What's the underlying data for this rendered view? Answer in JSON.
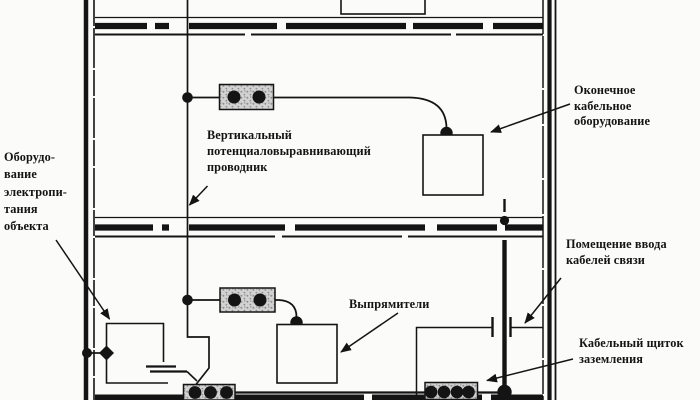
{
  "colors": {
    "ink": "#141414",
    "paper": "#fbfbf9",
    "busbar_fill": "#d2d2d2",
    "busbar_speckle": "#8f8f8f"
  },
  "labels": {
    "power_equipment": "Оборудо-\nвание\nэлектропи-\nтания\nобъекта",
    "vertical_conductor": "Вертикальный\nпотенциаловыравнивающий\nпроводник",
    "terminal_cable_equipment": "Оконечное\nкабельное\nоборудование",
    "cable_entry_room": "Помещение ввода\nкабелей связи",
    "rectifiers": "Выпрямители",
    "grounding_cable_panel": "Кабельный щиток\nзаземления"
  }
}
